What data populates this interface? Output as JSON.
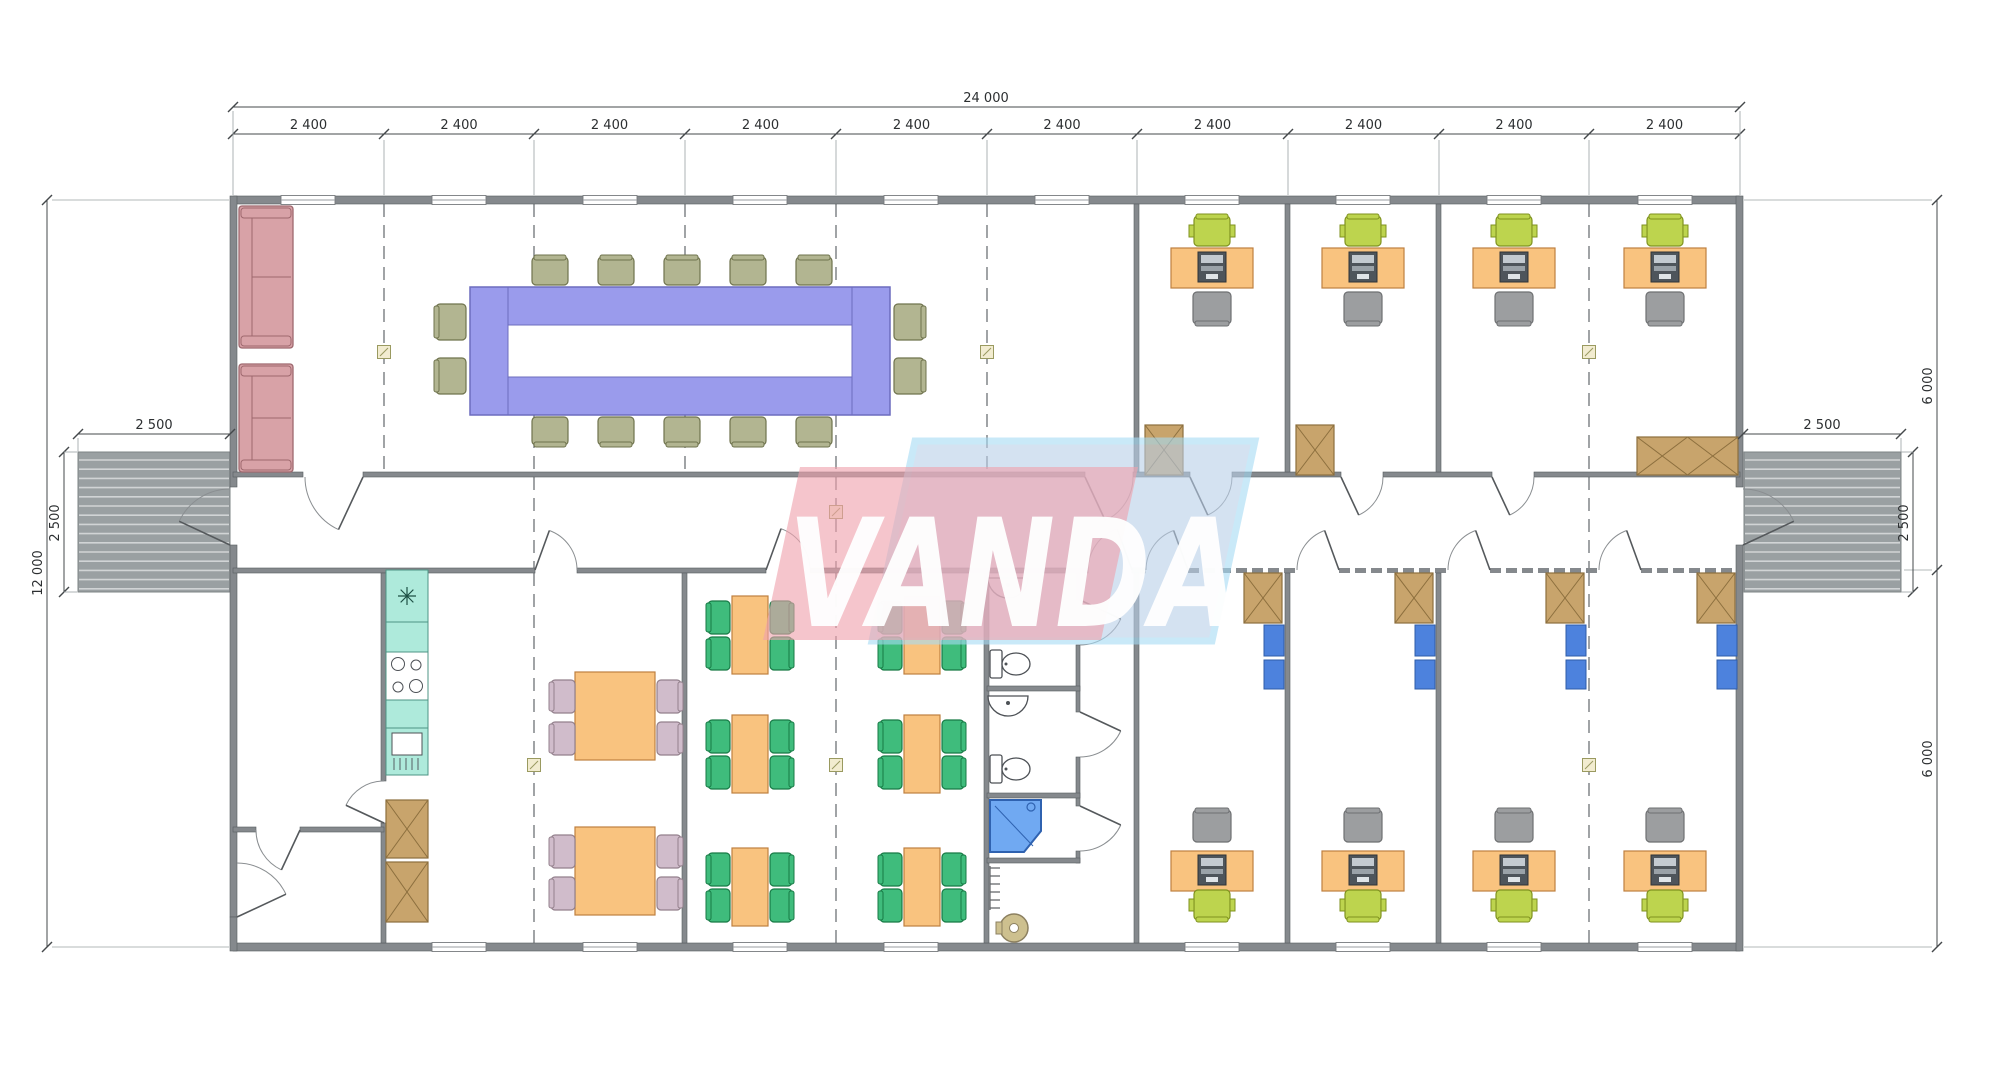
{
  "watermark": {
    "text": "VANDA",
    "pink": "#efa2ac",
    "blue": "#b9cfe8",
    "frame_blue": "#a6dcf5",
    "letter_color": "#ffffff"
  },
  "dimensions": {
    "overall_width": "24 000",
    "bay_labels": [
      "2 400",
      "2 400",
      "2 400",
      "2 400",
      "2 400",
      "2 400",
      "2 400",
      "2 400",
      "2 400",
      "2 400"
    ],
    "overall_height": "12 000",
    "upper_right_height": "6 000",
    "lower_right_height": "6 000",
    "left_porch_width": "2 500",
    "left_porch_depth": "2 500",
    "right_porch_width": "2 500",
    "right_porch_depth": "2 500"
  },
  "palette": {
    "wall": "#85898d",
    "wall_edge": "#585c60",
    "grid": "#6e7276",
    "dim": "#44484b",
    "ext": "#9aa0a3",
    "porch": "#9aa0a2",
    "porch_stripe": "#ffffff",
    "purple_table": "#9a9bec",
    "purple_border": "#6c6cbe",
    "olive_chair": "#b2b591",
    "olive_border": "#6f734d",
    "sofa_pink": "#d8a2a7",
    "sofa_border": "#9e686e",
    "desk_orange": "#f9c37f",
    "desk_border": "#bf8040",
    "lime_chair": "#bdd44e",
    "lime_border": "#7f921f",
    "task_gray": "#9c9ea0",
    "task_border": "#6e7072",
    "mauve_chair": "#d0bccb",
    "mauve_border": "#93808c",
    "green_chair": "#3fbc7c",
    "green_border": "#177a45",
    "teal_kitchen": "#aeeadb",
    "teal_border": "#4d9484",
    "wood": "#c8a46c",
    "wood_border": "#8c6f3e",
    "shelf_blue": "#4d82dd",
    "shelf_border": "#2f5ca8",
    "shower_blue": "#70a9f2",
    "shower_border": "#2f62b0",
    "heater_tan": "#cdc08f",
    "heater_border": "#8c8060",
    "fixture_line": "#4d5156",
    "marker_fill": "#f2ecd0",
    "marker_line": "#9a9a60",
    "computer_dark": "#4e555b",
    "computer_light": "#c3cad0"
  },
  "inventory": {
    "meeting_room": {
      "conference_table": 1,
      "conference_chairs": 14,
      "sofas": 2
    },
    "top_offices": {
      "rooms": 3,
      "workstations": 4,
      "desks": 4,
      "computers": 4,
      "task_chairs": 4,
      "guest_chairs": 4,
      "wardrobes": 3
    },
    "bottom_offices": {
      "rooms": 3,
      "workstations": 4,
      "desks": 4,
      "computers": 4,
      "task_chairs": 4,
      "guest_chairs": 4,
      "wardrobes": 4,
      "shelving_units": 4
    },
    "kitchen": {
      "sink_units": 2,
      "cooktop": 1,
      "fridge": 1,
      "cabinets": 2
    },
    "dining_room": {
      "tables": 2,
      "chairs": 8
    },
    "cafeteria": {
      "tables": 6,
      "chairs": 24
    },
    "sanitary_block": {
      "wc_rooms": 2,
      "toilets": 2,
      "basins": 2,
      "shower": 1,
      "water_heater": 1,
      "radiator": 1
    },
    "porches": 2
  }
}
